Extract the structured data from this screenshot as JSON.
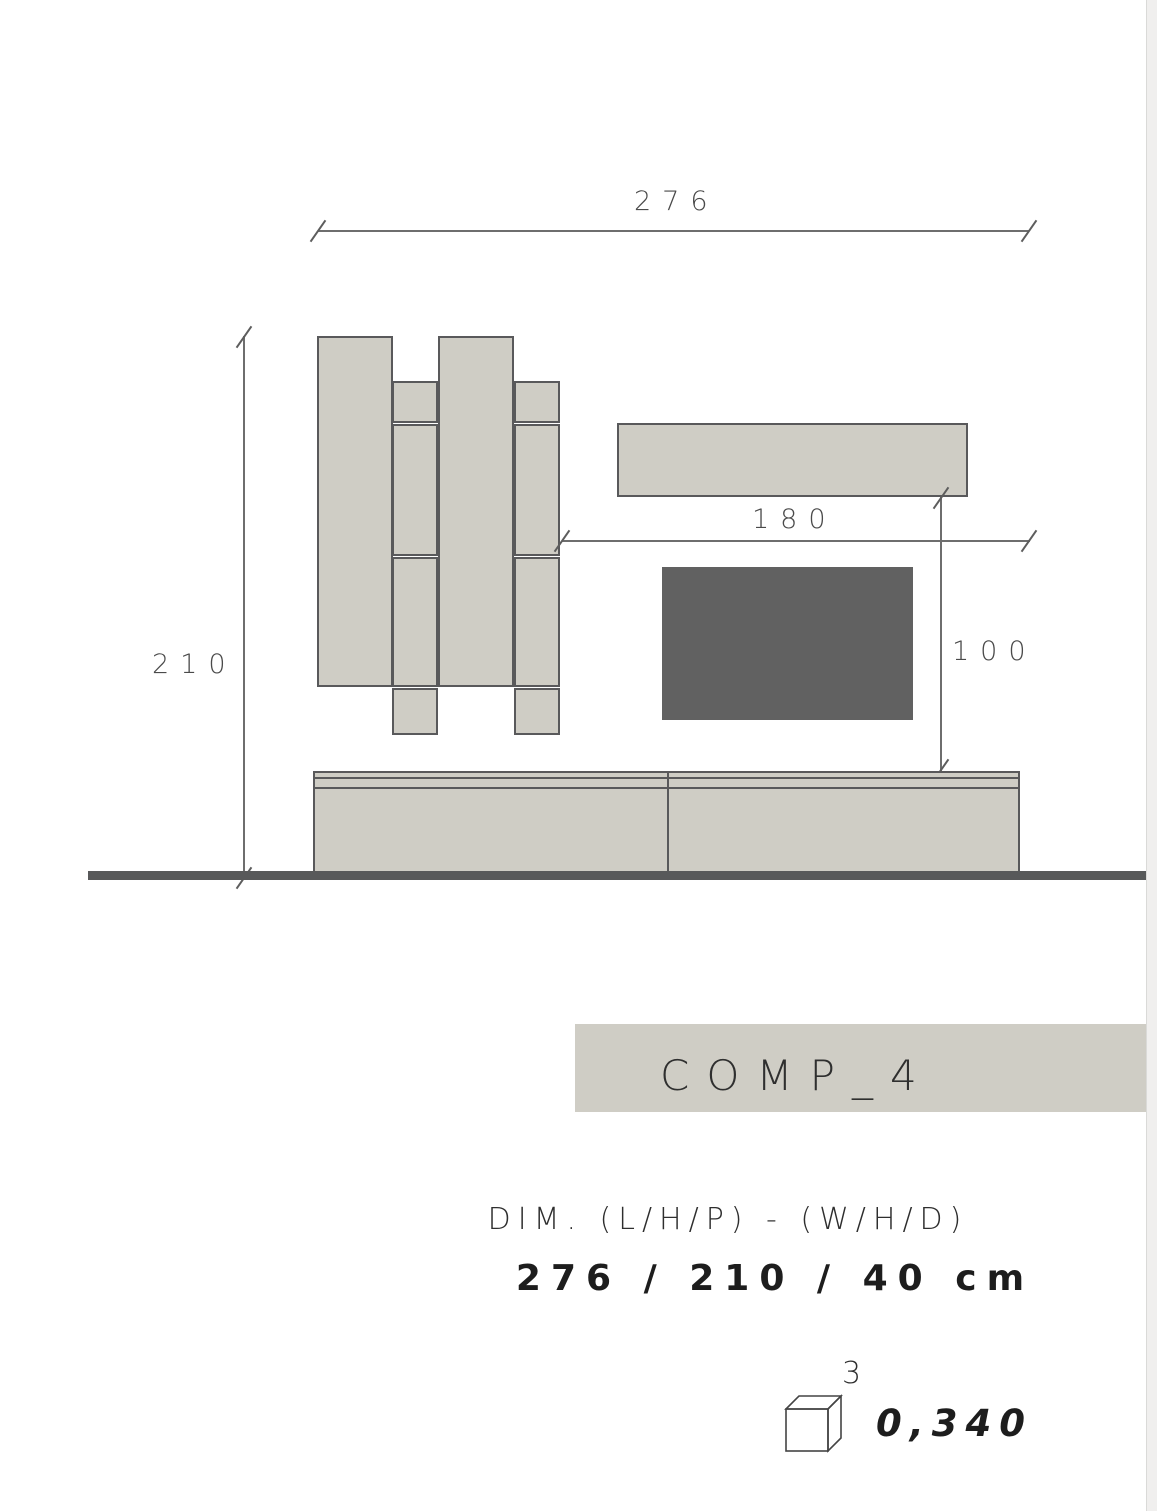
{
  "drawing": {
    "total_width_label": "276",
    "total_height_label": "210",
    "shelf_span_label": "180",
    "tv_drop_label": "100",
    "colors": {
      "panel_fill": "#cfcdc5",
      "panel_stroke": "#59595b",
      "tv_fill": "#616161",
      "floor": "#58595a",
      "dim_line": "#6e6e6e"
    }
  },
  "banner": {
    "label": "COMP_4",
    "bg": "#cfcdc5"
  },
  "specs": {
    "dim_caption": "DIM. (L/H/P) - (W/H/D)",
    "dim_values": "276 / 210 / 40 cm",
    "volume_exponent": "3",
    "volume_value": "0,340"
  }
}
